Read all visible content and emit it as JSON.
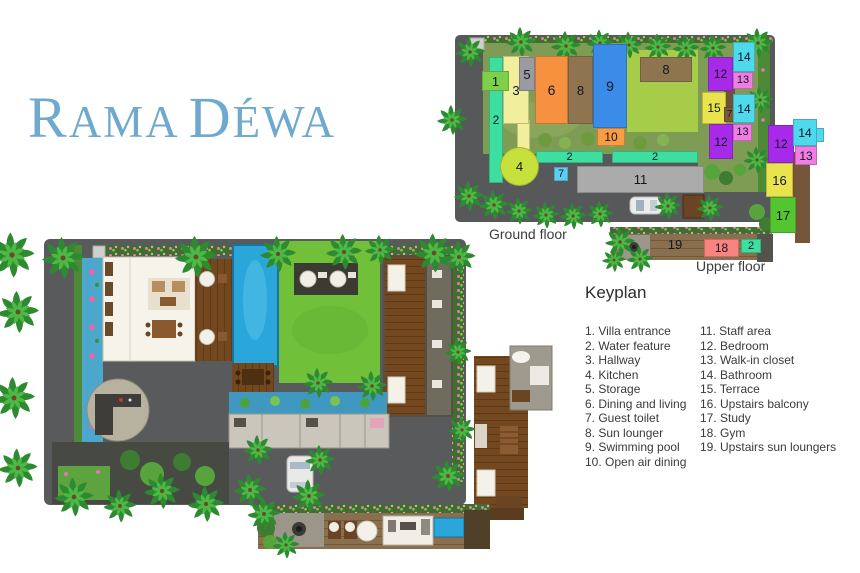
{
  "logo": {
    "part1": "R",
    "part2": "AMA",
    "part3": "D",
    "part4": "ÉWA",
    "color": "#6fa9ce"
  },
  "ground_floor": {
    "label": "Ground floor",
    "rooms": [
      {
        "n": "2",
        "x": 489,
        "y": 57,
        "w": 14,
        "h": 126,
        "c": "#3ddfa1",
        "fs": 12
      },
      {
        "n": "",
        "x": 517,
        "y": 120,
        "w": 13,
        "h": 30,
        "c": "#f1ee9e",
        "fs": 0
      },
      {
        "n": "3",
        "x": 503,
        "y": 56,
        "w": 26,
        "h": 68,
        "c": "#f1ee9e",
        "fs": 13
      },
      {
        "n": "1",
        "x": 482,
        "y": 71,
        "w": 27,
        "h": 20,
        "c": "#7ed04a",
        "fs": 13
      },
      {
        "n": "5",
        "x": 519,
        "y": 57,
        "w": 16,
        "h": 34,
        "c": "#9a9aa2",
        "fs": 13
      },
      {
        "n": "6",
        "x": 535,
        "y": 56,
        "w": 33,
        "h": 68,
        "c": "#f69140",
        "fs": 14
      },
      {
        "n": "8",
        "x": 568,
        "y": 56,
        "w": 25,
        "h": 68,
        "c": "#8f7450",
        "fs": 13
      },
      {
        "n": "9",
        "x": 593,
        "y": 44,
        "w": 34,
        "h": 84,
        "c": "#3a8ce8",
        "fs": 14
      },
      {
        "n": "10",
        "x": 597,
        "y": 128,
        "w": 28,
        "h": 18,
        "c": "#f89d42",
        "fs": 12
      },
      {
        "n": "8",
        "x": 640,
        "y": 57,
        "w": 52,
        "h": 25,
        "c": "#8f7450",
        "fs": 13
      },
      {
        "n": "12",
        "x": 708,
        "y": 57,
        "w": 25,
        "h": 34,
        "c": "#a72ae8",
        "fs": 12
      },
      {
        "n": "14",
        "x": 733,
        "y": 42,
        "w": 22,
        "h": 30,
        "c": "#4fd9ec",
        "fs": 12
      },
      {
        "n": "13",
        "x": 733,
        "y": 72,
        "w": 20,
        "h": 17,
        "c": "#f07de4",
        "fs": 11
      },
      {
        "n": "15",
        "x": 702,
        "y": 92,
        "w": 24,
        "h": 32,
        "c": "#e9e44d",
        "fs": 12
      },
      {
        "n": "7",
        "x": 724,
        "y": 107,
        "w": 11,
        "h": 15,
        "c": "#7b5a35",
        "fs": 10
      },
      {
        "n": "14",
        "x": 733,
        "y": 94,
        "w": 22,
        "h": 29,
        "c": "#4fd9ec",
        "fs": 12
      },
      {
        "n": "13",
        "x": 733,
        "y": 124,
        "w": 19,
        "h": 17,
        "c": "#f07de4",
        "fs": 11
      },
      {
        "n": "12",
        "x": 709,
        "y": 124,
        "w": 24,
        "h": 35,
        "c": "#a72ae8",
        "fs": 12
      },
      {
        "n": "2",
        "x": 536,
        "y": 151,
        "w": 67,
        "h": 12,
        "c": "#3ddfa1",
        "fs": 11
      },
      {
        "n": "2",
        "x": 612,
        "y": 151,
        "w": 86,
        "h": 12,
        "c": "#3ddfa1",
        "fs": 11
      },
      {
        "n": "7",
        "x": 554,
        "y": 167,
        "w": 14,
        "h": 14,
        "c": "#5ecdf5",
        "fs": 11
      },
      {
        "n": "11",
        "x": 577,
        "y": 166,
        "w": 127,
        "h": 27,
        "c": "#ababab",
        "fs": 13
      },
      {
        "n": "4",
        "x": 500,
        "y": 147,
        "w": 39,
        "h": 39,
        "c": "#c6e03c",
        "fs": 13,
        "r": true
      }
    ]
  },
  "upper_floor": {
    "label": "Upper floor",
    "rooms": [
      {
        "n": "19",
        "x": 652,
        "y": 233,
        "w": 46,
        "h": 23,
        "c": "transparent",
        "fs": 13
      },
      {
        "n": "18",
        "x": 704,
        "y": 239,
        "w": 35,
        "h": 18,
        "c": "#f8837f",
        "fs": 12
      },
      {
        "n": "2",
        "x": 741,
        "y": 239,
        "w": 20,
        "h": 14,
        "c": "#3ddfa1",
        "fs": 11
      },
      {
        "n": "",
        "x": 815,
        "y": 128,
        "w": 9,
        "h": 14,
        "c": "#4fd9ec",
        "fs": 0
      },
      {
        "n": "12",
        "x": 768,
        "y": 125,
        "w": 26,
        "h": 38,
        "c": "#a72ae8",
        "fs": 12
      },
      {
        "n": "14",
        "x": 793,
        "y": 119,
        "w": 24,
        "h": 27,
        "c": "#4fd9ec",
        "fs": 12
      },
      {
        "n": "13",
        "x": 795,
        "y": 146,
        "w": 22,
        "h": 19,
        "c": "#f07de4",
        "fs": 12
      },
      {
        "n": "16",
        "x": 766,
        "y": 163,
        "w": 27,
        "h": 34,
        "c": "#e9e44d",
        "fs": 13
      },
      {
        "n": "17",
        "x": 770,
        "y": 197,
        "w": 26,
        "h": 36,
        "c": "#55c431",
        "fs": 13
      }
    ]
  },
  "keyplan": {
    "title": "Keyplan",
    "col1": [
      {
        "n": "1.",
        "label": "Villa entrance"
      },
      {
        "n": "2.",
        "label": "Water feature"
      },
      {
        "n": "3.",
        "label": "Hallway"
      },
      {
        "n": "4.",
        "label": "Kitchen"
      },
      {
        "n": "5.",
        "label": "Storage"
      },
      {
        "n": "6.",
        "label": "Dining and living"
      },
      {
        "n": "7.",
        "label": "Guest toilet"
      },
      {
        "n": "8.",
        "label": "Sun lounger"
      },
      {
        "n": "9.",
        "label": "Swimming pool"
      },
      {
        "n": "10.",
        "label": "Open air dining"
      }
    ],
    "col2": [
      {
        "n": "11.",
        "label": "Staff area"
      },
      {
        "n": "12.",
        "label": "Bedroom"
      },
      {
        "n": "13.",
        "label": "Walk-in closet"
      },
      {
        "n": "14.",
        "label": "Bathroom"
      },
      {
        "n": "15.",
        "label": "Terrace"
      },
      {
        "n": "16.",
        "label": "Upstairs balcony"
      },
      {
        "n": "17.",
        "label": "Study"
      },
      {
        "n": "18.",
        "label": "Gym"
      },
      {
        "n": "19.",
        "label": "Upstairs sun loungers"
      }
    ]
  }
}
